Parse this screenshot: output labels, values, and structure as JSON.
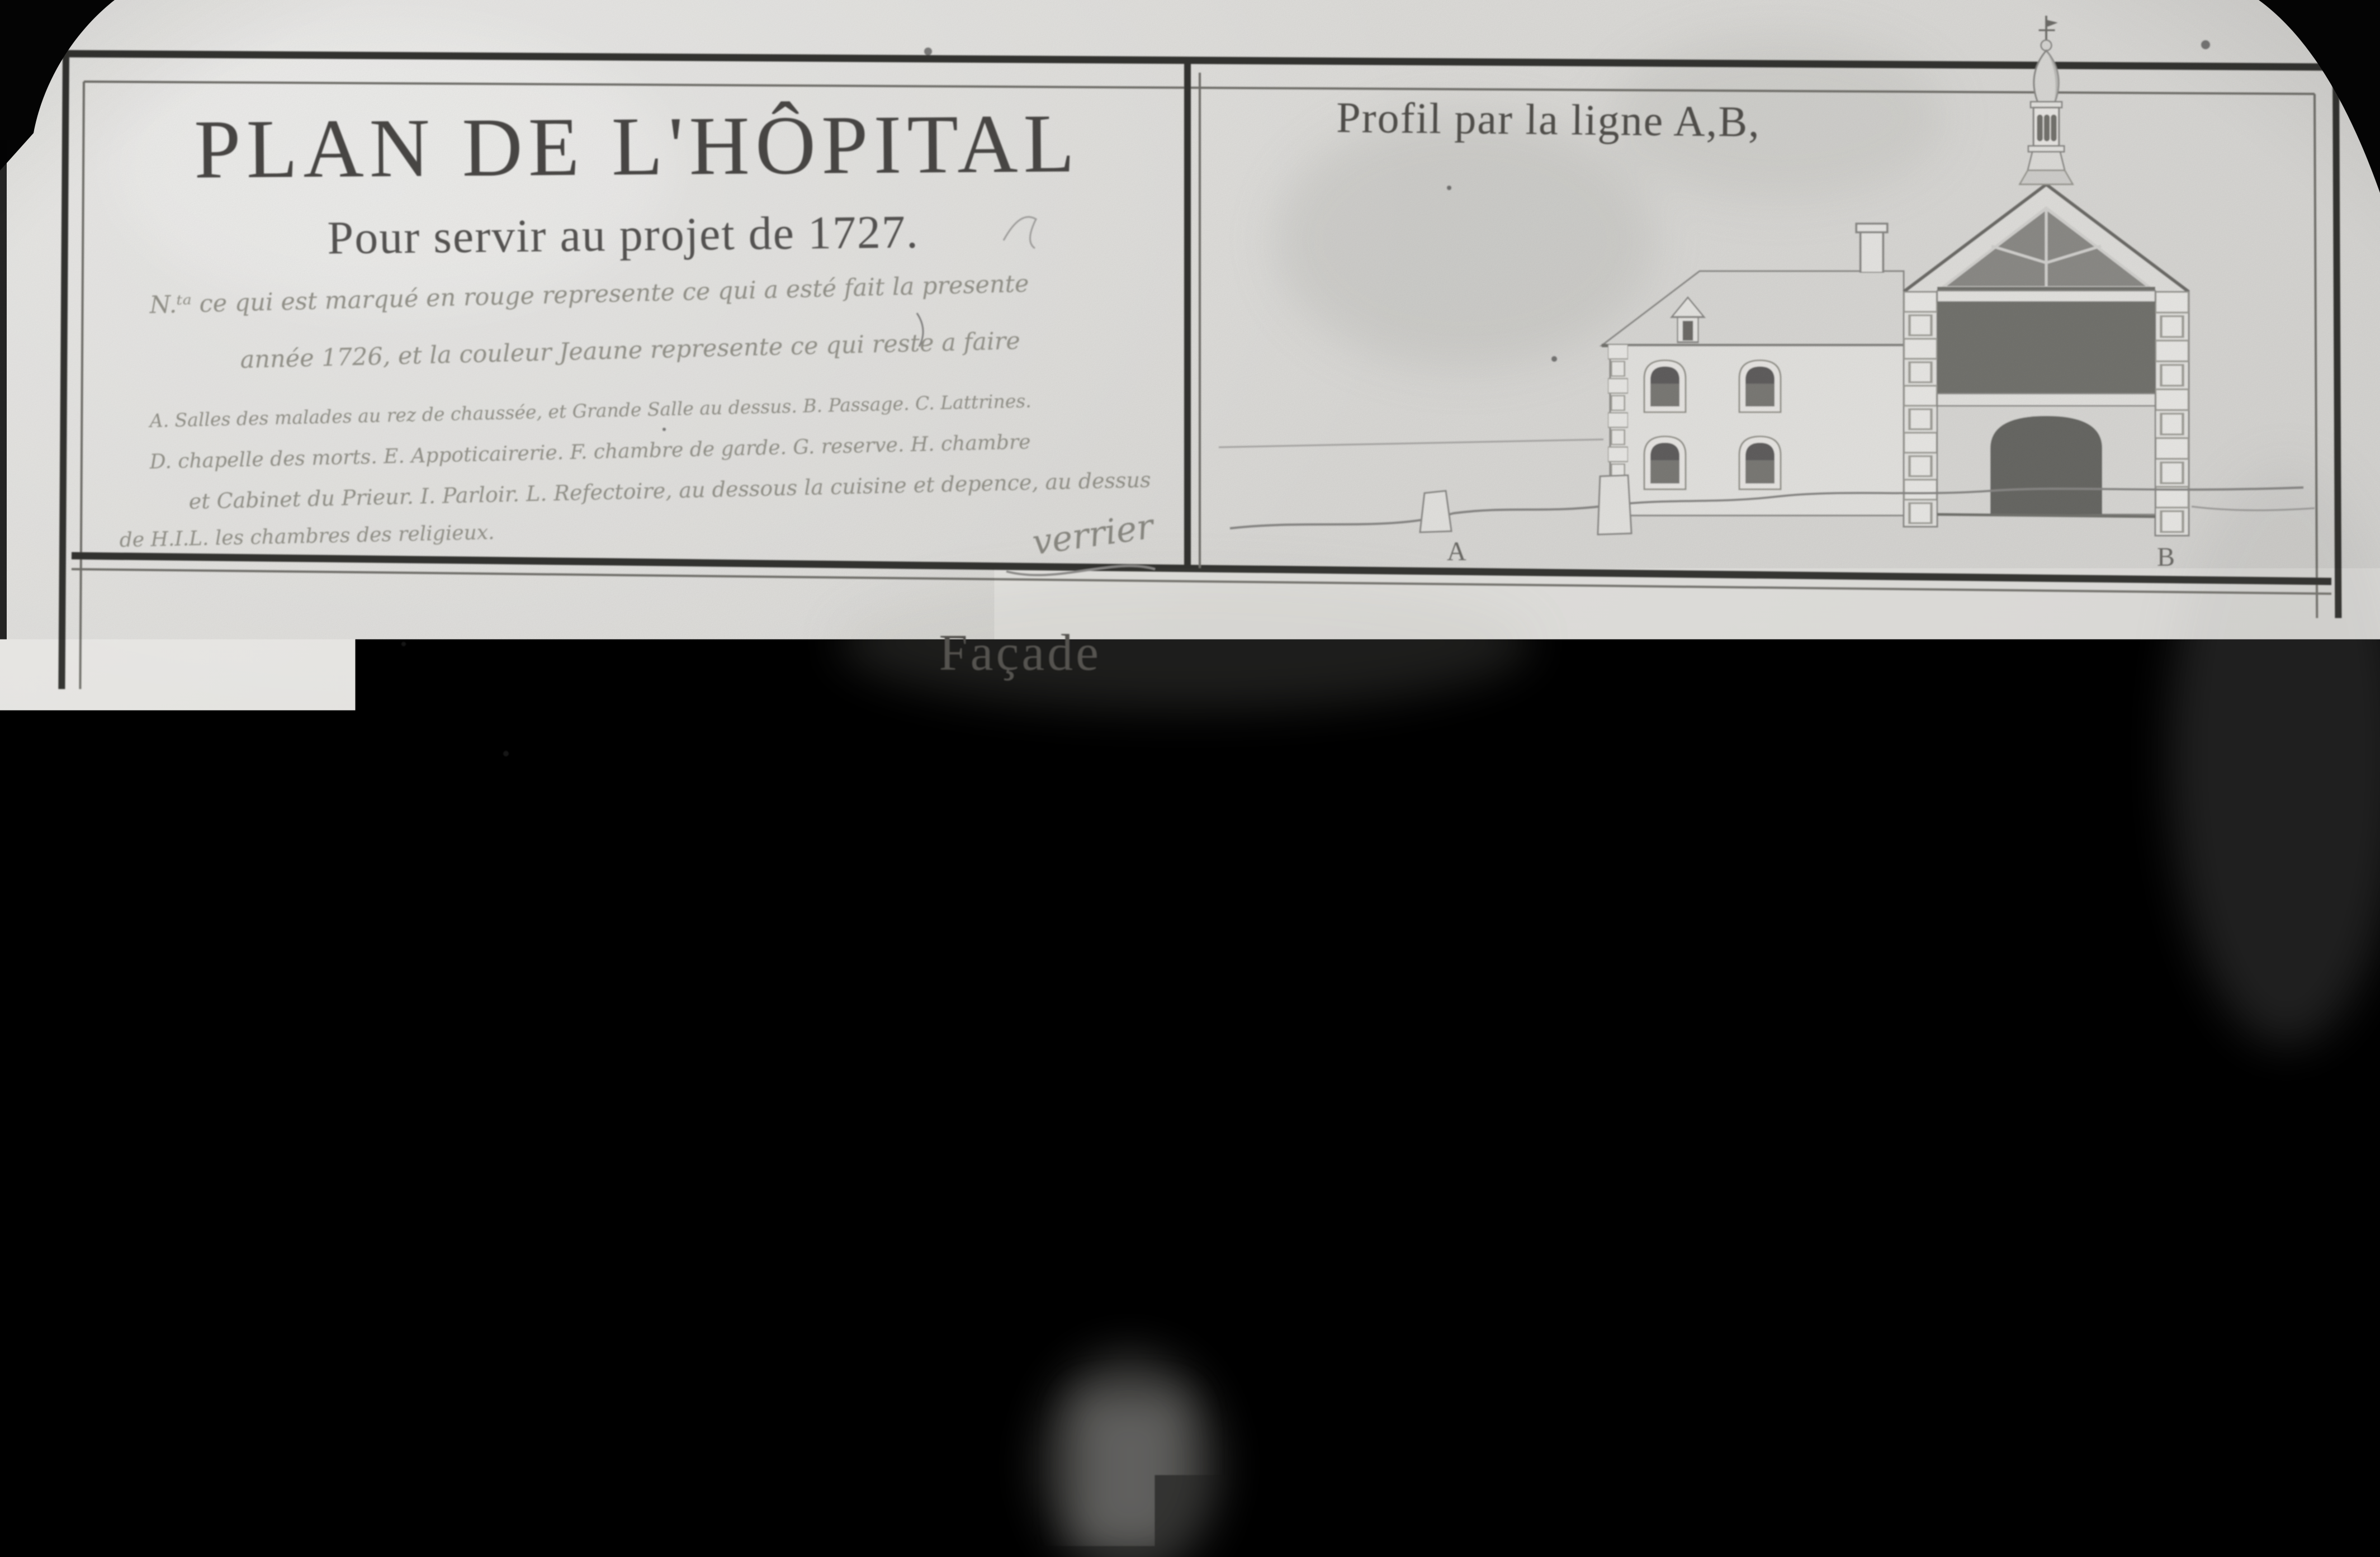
{
  "photo": {
    "description": "black-and-white archival photograph of a 1727 hand-drawn hospital plan",
    "colors": {
      "paper": "#deddda",
      "ink_dark": "#343431",
      "ink_mid": "#8a8987",
      "wash_dark": "#75746f",
      "film_black": "#050505"
    }
  },
  "title_block": {
    "title": "PLAN DE L'HÔPITAL",
    "subtitle": "Pour servir au projet de 1727.",
    "note_lines": [
      "N.ᵗᵃ ce qui est marqué en rouge represente ce qui a esté fait la presente",
      "année 1726, et la couleur Jeaune represente ce qui reste a faire"
    ],
    "legend_lines": [
      "A. Salles des malades au rez de chaussée, et Grande Salle au dessus. B. Passage. C. Lattrines.",
      "D. chapelle des morts. E. Appoticairerie. F. chambre de garde. G. reserve. H. chambre",
      "et Cabinet du Prieur. I. Parloir. L. Refectoire, au dessous la cuisine et depence, au dessus",
      "de H.I.L. les chambres des religieux."
    ],
    "signature": "verrier"
  },
  "profil_panel": {
    "title": "Profil par la ligne A,B,",
    "label_a": "A",
    "label_b": "B"
  },
  "facade_panel": {
    "title_left": "Façade du",
    "title_right": "coſté de la Cour"
  },
  "plan_panel": {
    "chapel": "ChapeL.",
    "label_b": "B",
    "label_h": "H"
  }
}
